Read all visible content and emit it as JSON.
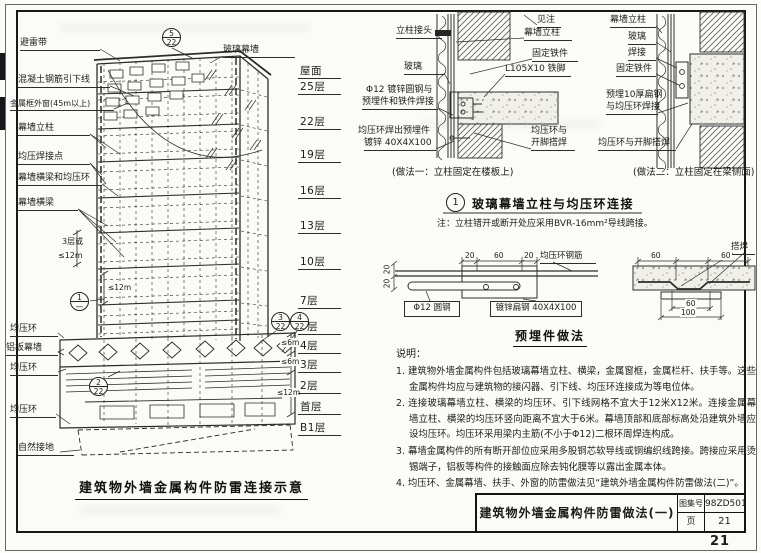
{
  "sheet": {
    "page_number": "21",
    "title_block": {
      "title": "建筑物外墙金属构件防雷做法(一)",
      "atlas_label": "图集号",
      "atlas_value": "98ZD501",
      "page_label": "页",
      "page_value": "21"
    }
  },
  "elevation": {
    "caption": "建筑物外墙金属构件防雷连接示意",
    "labels": {
      "lightning_belt": "避雷带",
      "down_conductor": "混凝土钢筋引下线",
      "metal_window": "金属框外窗(45m以上)",
      "mullion": "幕墙立柱",
      "weld_point": "均压焊接点",
      "beam_ring": "幕墙横梁和均压环",
      "beam": "幕墙横梁",
      "glass_wall": "玻璃幕墙",
      "ring1": "均压环",
      "alu_panel": "铝板幕墙",
      "ring2": "均压环",
      "ring3": "均压环",
      "ground": "自然接地",
      "three_floors": "3层或",
      "lt12_a": "≤12m",
      "lt12_b": "≤12m",
      "lt6_a": "≤6m",
      "lt6_b": "≤6m",
      "lt12_c": "≤12m"
    },
    "floors": [
      "屋面",
      "25层",
      "22层",
      "19层",
      "16层",
      "13层",
      "10层",
      "7层",
      "5层",
      "4层",
      "3层",
      "2层",
      "首层",
      "B1层"
    ],
    "bubbles": {
      "b5": {
        "top": "5",
        "bot": "22"
      },
      "b1": {
        "top": "1",
        "bot": "—"
      },
      "b2": {
        "top": "2",
        "bot": "22"
      },
      "b3": {
        "top": "3",
        "bot": "22"
      },
      "b4": {
        "top": "4",
        "bot": "22"
      }
    }
  },
  "detail1": {
    "caption": "(做法一：立柱固定在楼板上)",
    "joint": "立柱接头",
    "glass": "玻璃",
    "rod1": "Φ12 镀锌圆钢与",
    "rod2": "预埋件和铁件焊接",
    "embed1": "均压环焊出预埋件",
    "embed2": "镀锌 40X4X100",
    "see_note": "见注",
    "mullion": "幕墙立柱",
    "fix": "固定铁件",
    "angle": "L105X10 铁脚",
    "ring1": "均压环与",
    "ring2": "开脚搭焊"
  },
  "detail2": {
    "caption": "(做法二：立柱固定在梁侧面)",
    "mullion": "幕墙立柱",
    "glass": "玻璃",
    "weld": "焊接",
    "fix": "固定铁件",
    "embed1": "预埋10厚扁钢",
    "embed2": "与均压环焊接",
    "ring": "均压环与开脚搭焊"
  },
  "connection": {
    "no": "1",
    "title": "玻璃幕墙立柱与均压环连接",
    "note": "注：立柱错开或断开处应采用BVR-16mm²导线跨接。"
  },
  "embed": {
    "caption": "预埋件做法",
    "left": {
      "d20a": "20",
      "d60": "60",
      "d20b": "20",
      "v20a": "20",
      "v20b": "20",
      "rebar": "均压环钢筋",
      "rod": "Φ12 圆钢",
      "plate": "镀锌扁钢 40X4X100"
    },
    "right": {
      "weld": "搭焊",
      "d60a": "60",
      "d60b": "60",
      "d60c": "60",
      "d100": "100"
    }
  },
  "notes": {
    "heading": "说明：",
    "items": [
      "1. 建筑物外墙金属构件包括玻璃幕墙立柱、横梁，金属窗框，金属栏杆、扶手等。这些金属构件均应与建筑物的接闪器、引下线、均压环连接成为等电位体。",
      "2. 连接玻璃幕墙立柱、横梁的均压环、引下线网格不宜大于12米X12米。连接金属幕墙立柱、横梁的均压环竖向距离不宜大于6米。幕墙顶部和底部标高处沿建筑外墙应设均压环。均压环采用梁内主筋(不小于Φ12)二根环周焊连构成。",
      "3. 幕墙金属构件的所有断开部位应采用多股铜芯软导线或铜编织线跨接。跨接应采用烫锡端子，铝板等构件的接触面应除去钝化膜等以露出金属本体。",
      "4. 均压环、金属幕墙、扶手、外窗的防雷做法见“建筑外墙金属构件防雷做法(二)”。"
    ]
  }
}
